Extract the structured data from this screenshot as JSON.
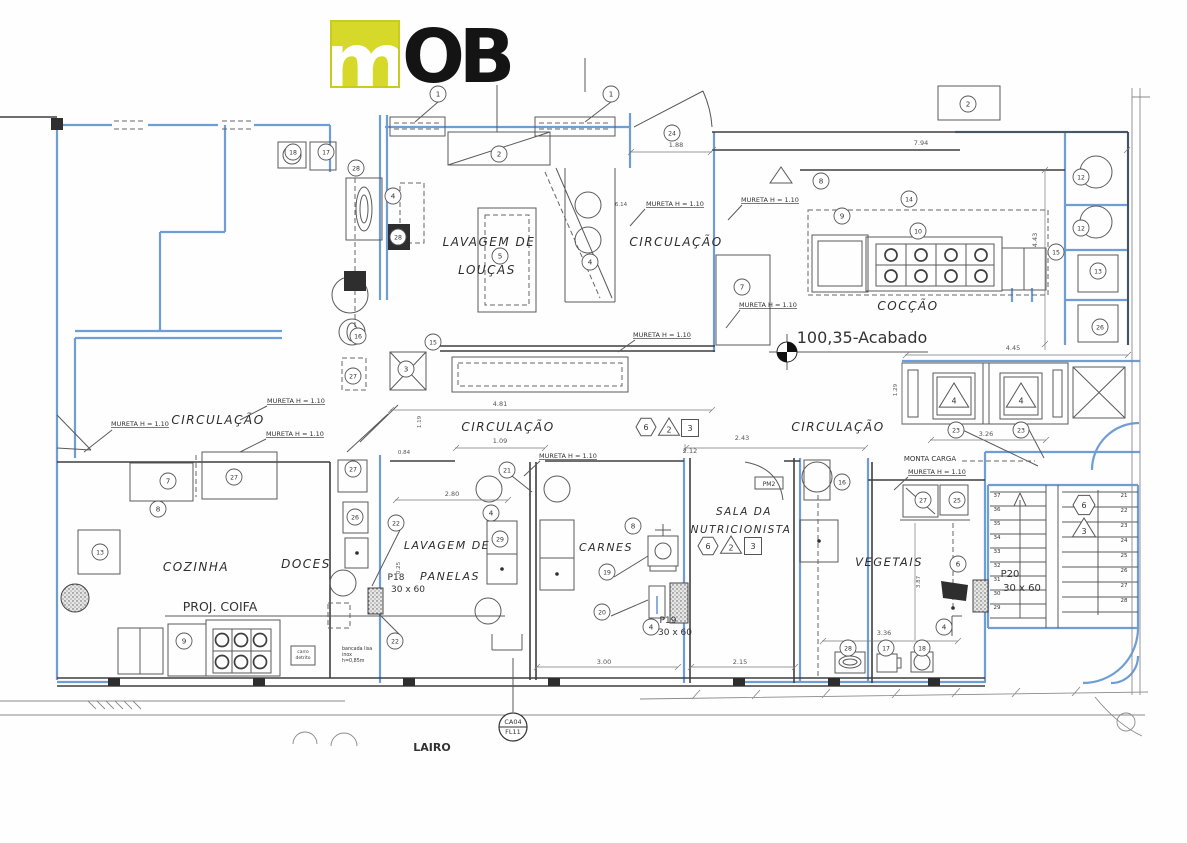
{
  "logo": {
    "text_m": "m",
    "text_ob": "OB",
    "yellow": "#d6d92a"
  },
  "colors": {
    "wall_blue": "#6f9dd6",
    "line_dark": "#3f3f3f",
    "logo_yellow": "#d6d92a"
  },
  "rooms": [
    {
      "t": "LAVAGEM DE",
      "x": 489,
      "y": 246,
      "fs": 12
    },
    {
      "t": "LOUÇAS",
      "x": 487,
      "y": 274,
      "fs": 12
    },
    {
      "t": "CIRCULAÇÃO",
      "x": 676,
      "y": 246,
      "fs": 12
    },
    {
      "t": "COCÇÃO",
      "x": 908,
      "y": 310,
      "fs": 12
    },
    {
      "t": "CIRCULAÇÃO",
      "x": 218,
      "y": 424,
      "fs": 12
    },
    {
      "t": "CIRCULAÇÃO",
      "x": 508,
      "y": 431,
      "fs": 12
    },
    {
      "t": "CIRCULAÇÃO",
      "x": 838,
      "y": 431,
      "fs": 12
    },
    {
      "t": "COZINHA",
      "x": 196,
      "y": 571,
      "fs": 12
    },
    {
      "t": "DOCES",
      "x": 306,
      "y": 568,
      "fs": 12
    },
    {
      "t": "LAVAGEM DE",
      "x": 447,
      "y": 549,
      "fs": 11
    },
    {
      "t": "PANELAS",
      "x": 450,
      "y": 580,
      "fs": 11
    },
    {
      "t": "CARNES",
      "x": 606,
      "y": 551,
      "fs": 11
    },
    {
      "t": "SALA DA",
      "x": 744,
      "y": 515,
      "fs": 10.5
    },
    {
      "t": "NUTRICIONISTA",
      "x": 741,
      "y": 533,
      "fs": 10.5
    },
    {
      "t": "VEGETAIS",
      "x": 889,
      "y": 566,
      "fs": 11.5
    }
  ],
  "annotations": [
    {
      "t": "MURETA H = 1.10",
      "x": 675,
      "y": 206,
      "fs": 6.5,
      "u": 1
    },
    {
      "t": "MURETA H = 1.10",
      "x": 770,
      "y": 202,
      "fs": 6.5,
      "u": 1
    },
    {
      "t": "MURETA H = 1.10",
      "x": 768,
      "y": 307,
      "fs": 6.5,
      "u": 1
    },
    {
      "t": "MURETA H = 1.10",
      "x": 662,
      "y": 337,
      "fs": 6.5,
      "u": 1
    },
    {
      "t": "MURETA H = 1.10",
      "x": 296,
      "y": 403,
      "fs": 6.5,
      "u": 1
    },
    {
      "t": "MURETA H = 1.10",
      "x": 140,
      "y": 426,
      "fs": 6.5,
      "u": 1
    },
    {
      "t": "MURETA H = 1.10",
      "x": 295,
      "y": 436,
      "fs": 6.5,
      "u": 1
    },
    {
      "t": "MURETA H = 1.10",
      "x": 568,
      "y": 458,
      "fs": 6.5,
      "u": 1
    },
    {
      "t": "MURETA H = 1.10",
      "x": 937,
      "y": 474,
      "fs": 6.5,
      "u": 1
    },
    {
      "t": "100,35-Acabado",
      "x": 862,
      "y": 343,
      "fs": 16,
      "it": 1
    },
    {
      "t": "MONTA CARGA",
      "x": 930,
      "y": 461,
      "fs": 7
    },
    {
      "t": "PROJ. COIFA",
      "x": 220,
      "y": 611,
      "fs": 12.5
    },
    {
      "t": "P18",
      "x": 396,
      "y": 580,
      "fs": 9
    },
    {
      "t": "30 x 60",
      "x": 408,
      "y": 592,
      "fs": 9
    },
    {
      "t": "P19",
      "x": 668,
      "y": 623,
      "fs": 9
    },
    {
      "t": "30 x 60",
      "x": 675,
      "y": 635,
      "fs": 9
    },
    {
      "t": "P20",
      "x": 1010,
      "y": 577,
      "fs": 10
    },
    {
      "t": "30 x 60",
      "x": 1022,
      "y": 591,
      "fs": 10
    },
    {
      "t": "PM2",
      "x": 769,
      "y": 486,
      "fs": 6
    },
    {
      "t": "carro",
      "x": 303,
      "y": 653,
      "fs": 4.5
    },
    {
      "t": "detrito",
      "x": 303,
      "y": 659,
      "fs": 4.5
    },
    {
      "t": "bancada lisa",
      "x": 342,
      "y": 650,
      "fs": 4.8,
      "a": "start"
    },
    {
      "t": "inox",
      "x": 342,
      "y": 656,
      "fs": 4.8,
      "a": "start"
    },
    {
      "t": "h=0,85m",
      "x": 342,
      "y": 662,
      "fs": 4.8,
      "a": "start"
    },
    {
      "t": "CA04",
      "x": 513,
      "y": 724,
      "fs": 6.5
    },
    {
      "t": "FL11",
      "x": 513,
      "y": 734,
      "fs": 6.5
    },
    {
      "t": "LAIRO",
      "x": 432,
      "y": 751,
      "fs": 11,
      "b": 1
    }
  ],
  "dimensions": [
    {
      "t": "7.94",
      "x": 921,
      "y": 145
    },
    {
      "t": "1.88",
      "x": 676,
      "y": 147
    },
    {
      "t": "6.14",
      "x": 621,
      "y": 206,
      "fs": 5.5
    },
    {
      "t": "4.43",
      "x": 1037,
      "y": 240,
      "r": -90
    },
    {
      "t": "4.45",
      "x": 1013,
      "y": 350
    },
    {
      "t": "4.81",
      "x": 500,
      "y": 406
    },
    {
      "t": "1.09",
      "x": 500,
      "y": 443
    },
    {
      "t": "2.43",
      "x": 742,
      "y": 440
    },
    {
      "t": "2.12",
      "x": 690,
      "y": 453
    },
    {
      "t": "0.84",
      "x": 404,
      "y": 454,
      "fs": 5.5
    },
    {
      "t": "1.19",
      "x": 421,
      "y": 422,
      "r": -90,
      "fs": 5.5
    },
    {
      "t": "1.29",
      "x": 897,
      "y": 390,
      "r": -90,
      "fs": 5.5
    },
    {
      "t": "3.26",
      "x": 986,
      "y": 436
    },
    {
      "t": "2.80",
      "x": 452,
      "y": 496
    },
    {
      "t": "3.00",
      "x": 604,
      "y": 664
    },
    {
      "t": "2.15",
      "x": 740,
      "y": 664
    },
    {
      "t": "3.36",
      "x": 884,
      "y": 635
    },
    {
      "t": "3.87",
      "x": 920,
      "y": 582,
      "r": -90,
      "fs": 5.5
    },
    {
      "t": "0.25",
      "x": 400,
      "y": 568,
      "r": -90,
      "fs": 5.5
    }
  ],
  "keynotes": [
    {
      "n": "1",
      "x": 438,
      "y": 94
    },
    {
      "n": "1",
      "x": 611,
      "y": 94
    },
    {
      "n": "2",
      "x": 499,
      "y": 154
    },
    {
      "n": "2",
      "x": 968,
      "y": 104
    },
    {
      "n": "24",
      "x": 672,
      "y": 133
    },
    {
      "n": "18",
      "x": 293,
      "y": 152
    },
    {
      "n": "17",
      "x": 326,
      "y": 152
    },
    {
      "n": "28",
      "x": 356,
      "y": 168
    },
    {
      "n": "4",
      "x": 393,
      "y": 196
    },
    {
      "n": "28",
      "x": 398,
      "y": 237
    },
    {
      "n": "16",
      "x": 358,
      "y": 336
    },
    {
      "n": "27",
      "x": 353,
      "y": 376
    },
    {
      "n": "5",
      "x": 500,
      "y": 256
    },
    {
      "n": "4",
      "x": 590,
      "y": 262
    },
    {
      "n": "7",
      "x": 742,
      "y": 287
    },
    {
      "n": "8",
      "x": 821,
      "y": 181
    },
    {
      "n": "9",
      "x": 842,
      "y": 216
    },
    {
      "n": "14",
      "x": 909,
      "y": 199
    },
    {
      "n": "10",
      "x": 918,
      "y": 231
    },
    {
      "n": "15",
      "x": 1056,
      "y": 252
    },
    {
      "n": "12",
      "x": 1081,
      "y": 177
    },
    {
      "n": "12",
      "x": 1081,
      "y": 228
    },
    {
      "n": "13",
      "x": 1098,
      "y": 271
    },
    {
      "n": "26",
      "x": 1100,
      "y": 327
    },
    {
      "n": "3",
      "x": 406,
      "y": 369
    },
    {
      "n": "15",
      "x": 433,
      "y": 342
    },
    {
      "n": "23",
      "x": 956,
      "y": 430
    },
    {
      "n": "23",
      "x": 1021,
      "y": 430
    },
    {
      "n": "16",
      "x": 842,
      "y": 482
    },
    {
      "n": "21",
      "x": 507,
      "y": 470
    },
    {
      "n": "27",
      "x": 234,
      "y": 477
    },
    {
      "n": "7",
      "x": 168,
      "y": 481
    },
    {
      "n": "8",
      "x": 158,
      "y": 509
    },
    {
      "n": "27",
      "x": 353,
      "y": 469
    },
    {
      "n": "26",
      "x": 355,
      "y": 517
    },
    {
      "n": "13",
      "x": 100,
      "y": 552
    },
    {
      "n": "22",
      "x": 396,
      "y": 523
    },
    {
      "n": "22",
      "x": 395,
      "y": 641
    },
    {
      "n": "4",
      "x": 491,
      "y": 513
    },
    {
      "n": "29",
      "x": 500,
      "y": 539
    },
    {
      "n": "8",
      "x": 633,
      "y": 526
    },
    {
      "n": "19",
      "x": 607,
      "y": 572
    },
    {
      "n": "20",
      "x": 602,
      "y": 612
    },
    {
      "n": "4",
      "x": 651,
      "y": 627
    },
    {
      "n": "27",
      "x": 923,
      "y": 500
    },
    {
      "n": "25",
      "x": 957,
      "y": 500
    },
    {
      "n": "6",
      "x": 958,
      "y": 564
    },
    {
      "n": "4",
      "x": 944,
      "y": 627
    },
    {
      "n": "28",
      "x": 848,
      "y": 648
    },
    {
      "n": "17",
      "x": 886,
      "y": 648
    },
    {
      "n": "18",
      "x": 922,
      "y": 648
    },
    {
      "n": "9",
      "x": 184,
      "y": 641
    }
  ],
  "badges": [
    {
      "s": "hex",
      "t": "6",
      "x": 646,
      "y": 427,
      "sz": 10
    },
    {
      "s": "tri",
      "t": "2",
      "x": 669,
      "y": 428,
      "sz": 10
    },
    {
      "s": "sq",
      "t": "3",
      "x": 690,
      "y": 428,
      "sz": 8.5
    },
    {
      "s": "hex",
      "t": "6",
      "x": 708,
      "y": 546,
      "sz": 10
    },
    {
      "s": "tri",
      "t": "2",
      "x": 731,
      "y": 546,
      "sz": 10
    },
    {
      "s": "sq",
      "t": "3",
      "x": 753,
      "y": 546,
      "sz": 8.5
    },
    {
      "s": "hex",
      "t": "6",
      "x": 1084,
      "y": 505,
      "sz": 11
    },
    {
      "s": "tri",
      "t": "3",
      "x": 1084,
      "y": 529,
      "sz": 11
    },
    {
      "s": "tri",
      "t": "4",
      "x": 954,
      "y": 397,
      "sz": 14
    },
    {
      "s": "tri",
      "t": "4",
      "x": 1021,
      "y": 397,
      "sz": 14
    }
  ],
  "stairs": {
    "left": [
      "37",
      "36",
      "35",
      "34",
      "33",
      "32",
      "31",
      "30",
      "29"
    ],
    "right": [
      "21",
      "22",
      "23",
      "24",
      "25",
      "26",
      "27",
      "28"
    ]
  }
}
